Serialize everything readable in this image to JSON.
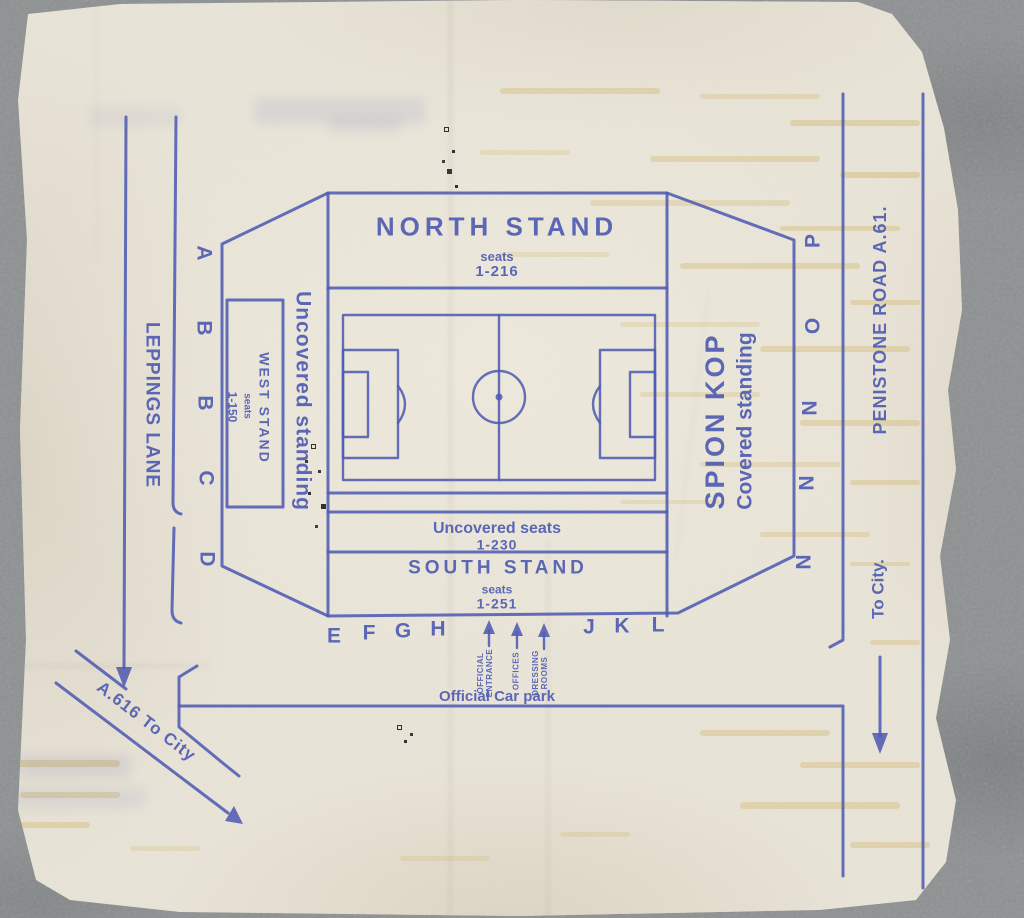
{
  "colors": {
    "ink": "#4a57b2",
    "paper": "#eae5d8",
    "background": "#8b8e8f"
  },
  "stadium": {
    "north_stand": {
      "title": "NORTH STAND",
      "seats_word": "seats",
      "seat_range": "1-216"
    },
    "west_stand": {
      "title": "WEST STAND",
      "seats_word": "seats",
      "seat_range": "1-150"
    },
    "south_stand": {
      "title": "SOUTH STAND",
      "seats_word": "seats",
      "seat_range": "1-251"
    },
    "uncovered_seats": {
      "title": "Uncovered seats",
      "seat_range": "1-230"
    },
    "west_terrace_label": "Uncovered standing",
    "east_terrace": {
      "title": "SPION KOP",
      "subtitle": "Covered standing"
    }
  },
  "roads": {
    "leppings_lane": "LEPPINGS LANE",
    "penistone_road": "PENISTONE ROAD  A.61.",
    "to_city_right": "To City.",
    "a616_to_city": "A.616 To City"
  },
  "facilities": {
    "official_car_park": "Official Car park",
    "official_entrance": "OFFICIAL\nENTRANCE",
    "offices": "OFFICES",
    "dressing_rooms": "DRESSING\nROOMS"
  },
  "gates": {
    "west": [
      "A",
      "B",
      "B",
      "C",
      "D"
    ],
    "east": [
      "P",
      "O",
      "N",
      "N",
      "N"
    ],
    "south_west": [
      "E",
      "F",
      "G",
      "H"
    ],
    "south_east": [
      "J",
      "K",
      "L"
    ]
  }
}
